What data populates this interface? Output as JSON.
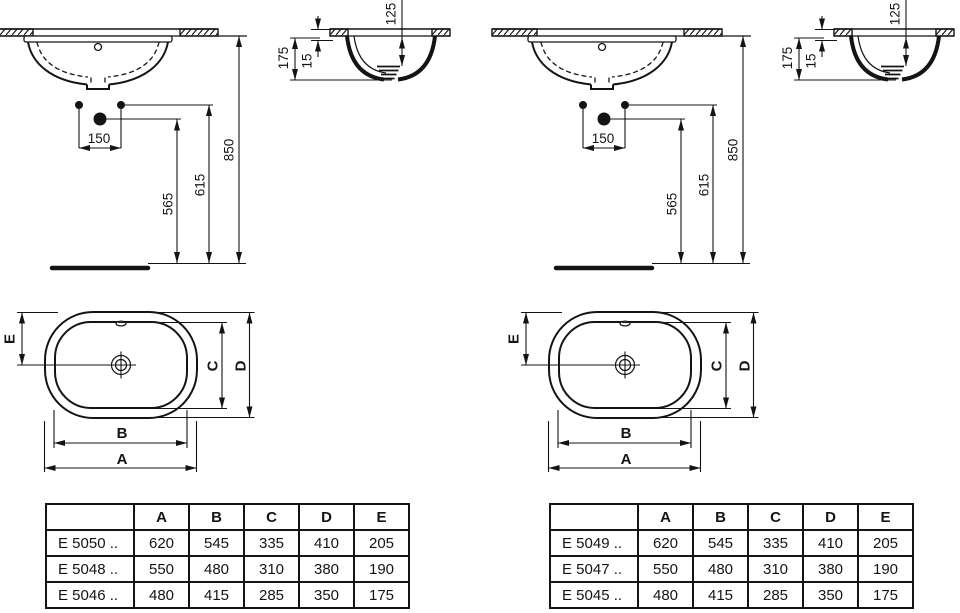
{
  "colors": {
    "line": "#141414",
    "background": "#ffffff"
  },
  "dims": {
    "front": {
      "tap_spacing": "150",
      "trap": "565",
      "outlet": "615",
      "rim": "850"
    },
    "side": {
      "total": "175",
      "rim": "15",
      "depth": "125"
    },
    "top": {
      "a": "A",
      "b": "B",
      "c": "C",
      "d": "D",
      "e": "E"
    }
  },
  "tables": [
    {
      "header": [
        "",
        "A",
        "B",
        "C",
        "D",
        "E"
      ],
      "rows": [
        {
          "model": "E 5050 ..",
          "values": [
            "620",
            "545",
            "335",
            "410",
            "205"
          ]
        },
        {
          "model": "E 5048 ..",
          "values": [
            "550",
            "480",
            "310",
            "380",
            "190"
          ]
        },
        {
          "model": "E 5046 ..",
          "values": [
            "480",
            "415",
            "285",
            "350",
            "175"
          ]
        }
      ]
    },
    {
      "header": [
        "",
        "A",
        "B",
        "C",
        "D",
        "E"
      ],
      "rows": [
        {
          "model": "E 5049 ..",
          "values": [
            "620",
            "545",
            "335",
            "410",
            "205"
          ]
        },
        {
          "model": "E 5047 ..",
          "values": [
            "550",
            "480",
            "310",
            "380",
            "190"
          ]
        },
        {
          "model": "E 5045 ..",
          "values": [
            "480",
            "415",
            "285",
            "350",
            "175"
          ]
        }
      ]
    }
  ]
}
